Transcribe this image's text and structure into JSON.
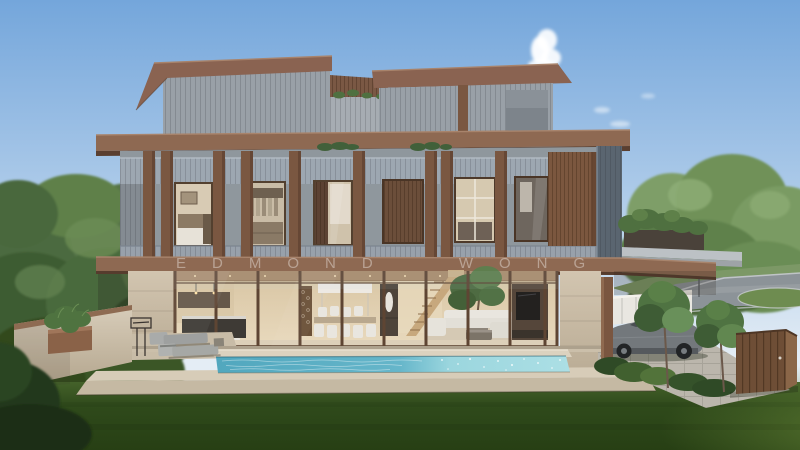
{
  "meta": {
    "canvas_width": 800,
    "canvas_height": 450,
    "image_type": "architectural-exterior-rendering"
  },
  "watermark": {
    "text": "EDMOND WONG"
  },
  "palette": {
    "sky_top": "#74A6DB",
    "sky_mid": "#A9C8E8",
    "sky_horizon": "#E4EDF5",
    "cloud": "#FFFFFF",
    "tree_dark": "#35502C",
    "tree_mid": "#4C6B3F",
    "tree_light": "#6B8C55",
    "grass_light": "#44622A",
    "grass_mid": "#2F4A1B",
    "grass_dark": "#273F14",
    "grass_sun": "#5E7C33",
    "road": "#8C9398",
    "curb": "#C9CDD0",
    "fence_white": "#E9E7E1",
    "wood_fascia": "#8A6351",
    "wood_dark": "#5E4130",
    "wood_fin": "#7A5741",
    "wood_gate": "#6E4E36",
    "clad_gray": "#99A0A7",
    "spandrel": "#9DA7B1",
    "panel_dark": "#5A6570",
    "stone_light": "#D8CDBA",
    "ceiling_wood": "#A98B6C",
    "pool_deep": "#51A7BE",
    "pool_light": "#9BD6DE",
    "furniture_white": "#E9E6DF",
    "car_body": "#73787C",
    "car_dark": "#3E4246",
    "driveway": "#BBB6AC"
  }
}
